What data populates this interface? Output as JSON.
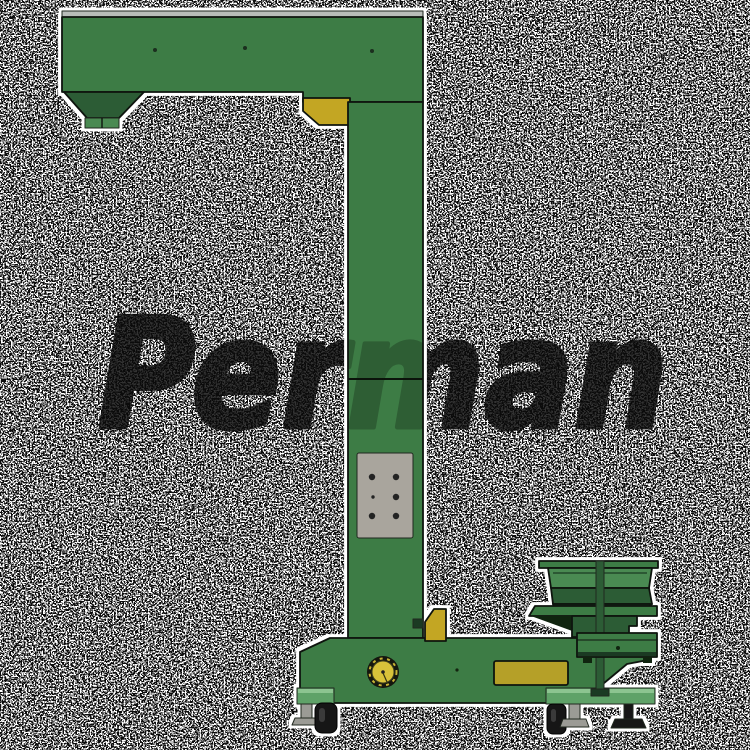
{
  "image": {
    "kind": "industrial product render",
    "subject": "Z-type bucket elevator with hopper, support column and vibratory bowl feeder on a wheeled base",
    "background_style": "black-and-white speckle noise dither"
  },
  "watermark": {
    "text": "Perman",
    "color": "#0b0b0b",
    "ghost_note": "letters faintly visible crossing the green column"
  },
  "colors": {
    "machine_green": "#3d7c45",
    "machine_green_light": "#4a8a52",
    "machine_green_mid": "#2c5c35",
    "machine_green_dark": "#1b3a23",
    "accent_yellow": "#c3a623",
    "plate_yellow": "#b5a028",
    "pulley_yellow": "#d8c23a",
    "panel_gray": "#a9a59d",
    "top_rail_gray": "#b9bdb9",
    "bracket_green": "#5fa268",
    "caster_black": "#161616",
    "leveling_foot_gray": "#9b9b95",
    "outline": "#0e140e",
    "noise_ink": "#0d0d0d",
    "background": "#ffffff"
  }
}
